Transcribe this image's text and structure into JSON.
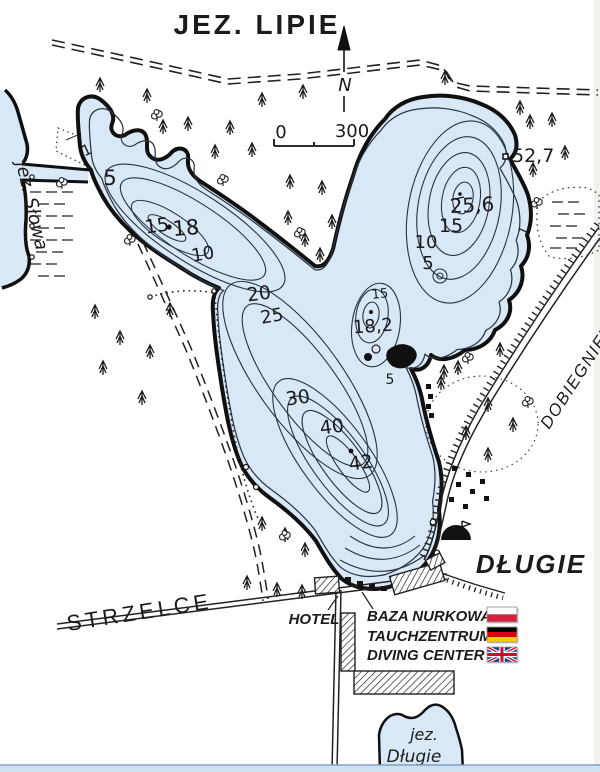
{
  "map": {
    "title": "JEZ. LIPIE",
    "north_label": "N",
    "scale_bar": {
      "start": "0",
      "end": "300"
    },
    "spot_height": "52,7",
    "lake_slowa_label": "jez. Słowa",
    "lake_dlugie_label_line1": "jez.",
    "lake_dlugie_label_line2": "Długie",
    "village_dlugie": "DŁUGIE",
    "town_dobiegniew": "DOBIEGNIEW",
    "town_strzelce": "STRZELCE",
    "hotel": "HOTEL",
    "diving_center": {
      "line1": "BAZA NURKOWA",
      "line2": "TAUCHZENTRUM",
      "line3": "DIVING CENTER",
      "flags": [
        "poland",
        "germany",
        "united-kingdom"
      ]
    },
    "depths": {
      "west": {
        "c1": "1",
        "c5": "5",
        "c15": "15",
        "spot18": "18",
        "c10": "10",
        "c20": "20",
        "c25": "25"
      },
      "main": {
        "c30": "30",
        "c40": "40",
        "spot42": "42"
      },
      "mid": {
        "c15": "15",
        "spot18_2": "18,2",
        "c5": "5"
      },
      "north": {
        "spot25_6": "25,6",
        "c15": "15",
        "c10": "10",
        "c5": "5",
        "c1": "1"
      }
    },
    "colors": {
      "water": "#d9e8f7",
      "ink": "#1b1b1b",
      "poland_red": "#d4213d",
      "germany_red": "#dd0000",
      "germany_gold": "#ffce00",
      "uk_blue": "#1e3f8f",
      "uk_red": "#c8102e"
    }
  }
}
